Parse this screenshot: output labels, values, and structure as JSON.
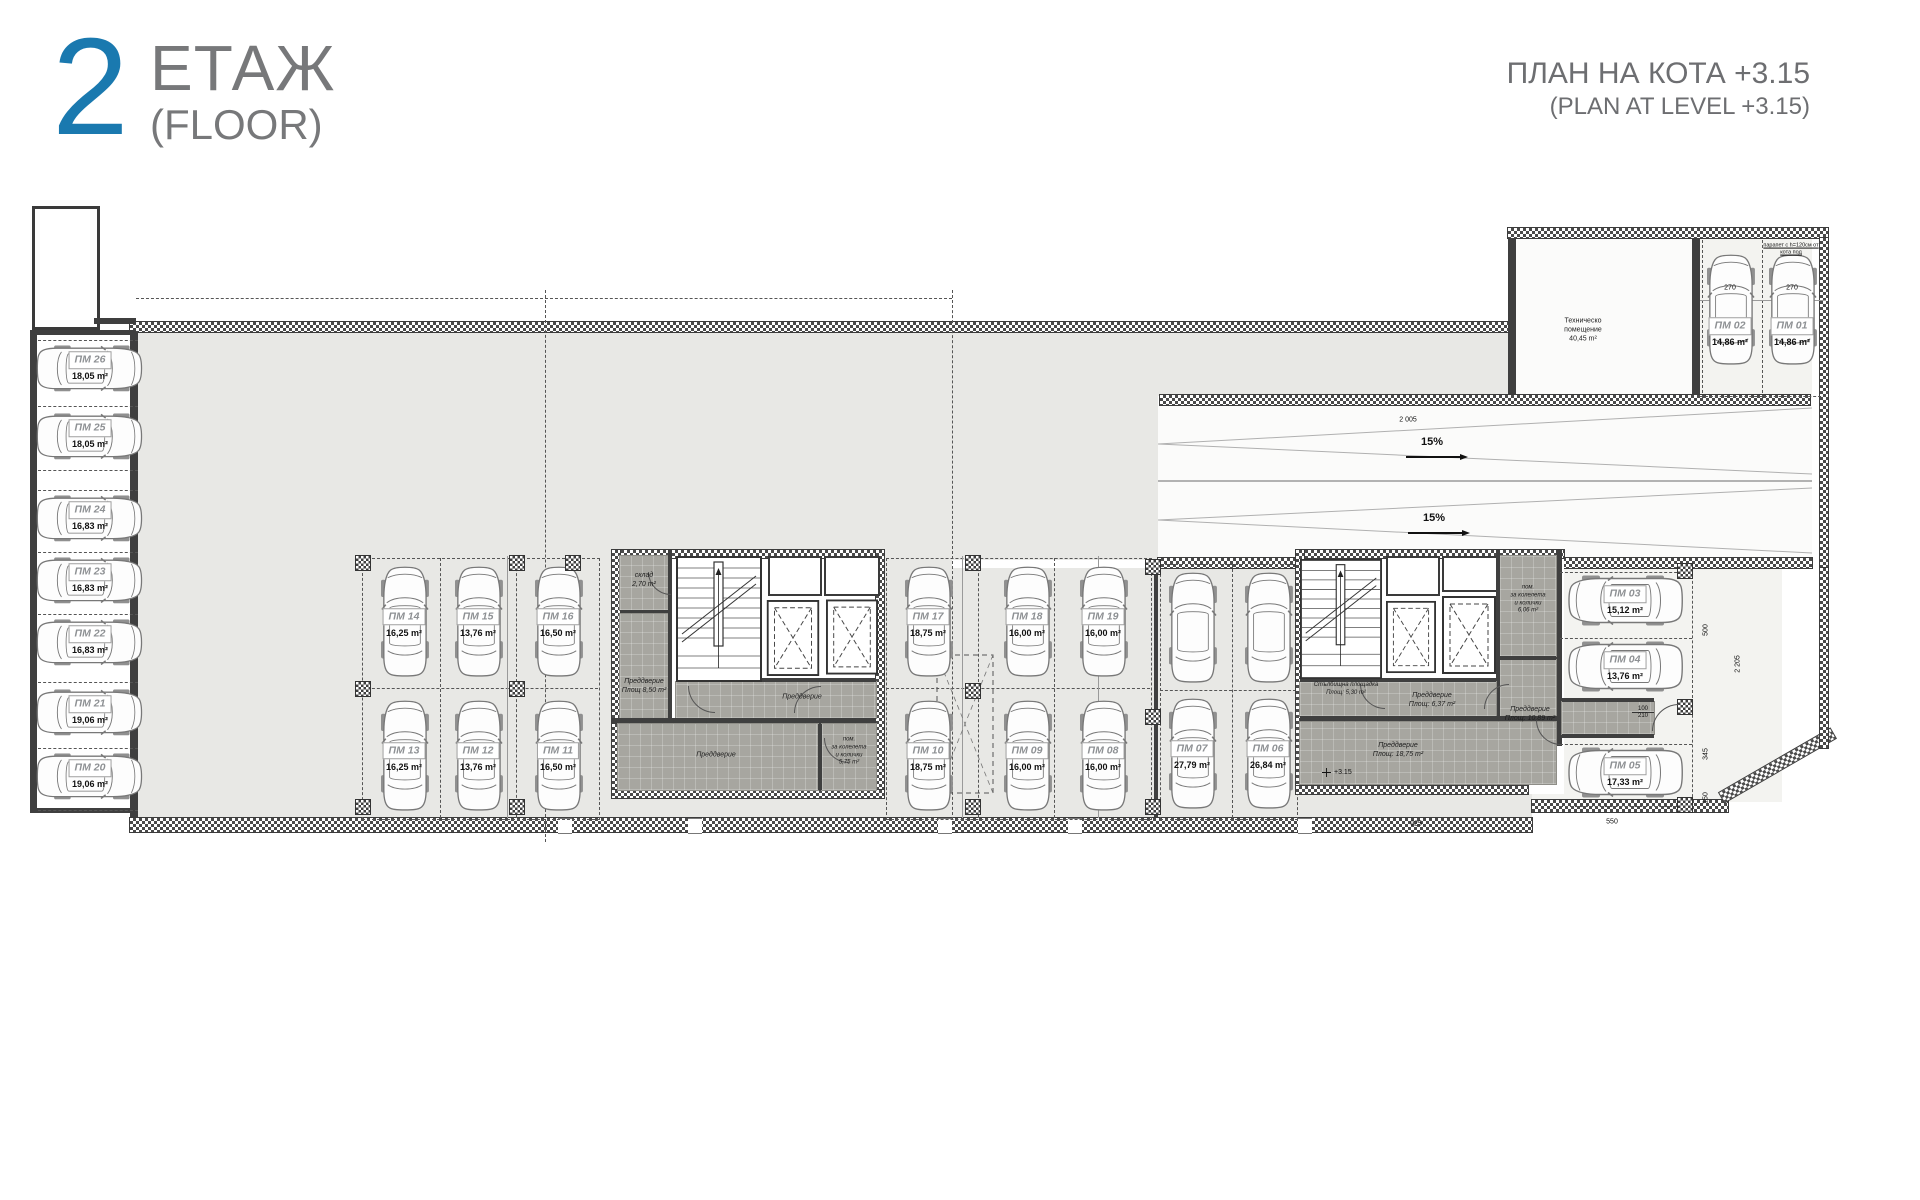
{
  "header": {
    "floor_number": "2",
    "floor_label": "ЕТАЖ",
    "floor_label_en": "(FLOOR)",
    "plan_title": "ПЛАН НА КОТА +3.15",
    "plan_title_en": "(PLAN AT LEVEL +3.15)",
    "accent_color": "#1a79af",
    "text_color": "#6d6e71"
  },
  "plan": {
    "spots": [
      {
        "id": "ПМ 01",
        "area": "14,86 m²"
      },
      {
        "id": "ПМ 02",
        "area": "14,86 m²"
      },
      {
        "id": "ПМ 03",
        "area": "15,12 m²"
      },
      {
        "id": "ПМ 04",
        "area": "13,76 m²"
      },
      {
        "id": "ПМ 05",
        "area": "17,33 m²"
      },
      {
        "id": "ПМ 06",
        "area": "26,84 m²"
      },
      {
        "id": "ПМ 07",
        "area": "27,79 m²"
      },
      {
        "id": "ПМ 08",
        "area": "16,00 m²"
      },
      {
        "id": "ПМ 09",
        "area": "16,00 m²"
      },
      {
        "id": "ПМ 10",
        "area": "18,75 m²"
      },
      {
        "id": "ПМ 11",
        "area": "16,50 m²"
      },
      {
        "id": "ПМ 12",
        "area": "13,76 m²"
      },
      {
        "id": "ПМ 13",
        "area": "16,25 m²"
      },
      {
        "id": "ПМ 14",
        "area": "16,25 m²"
      },
      {
        "id": "ПМ 15",
        "area": "13,76 m²"
      },
      {
        "id": "ПМ 16",
        "area": "16,50 m²"
      },
      {
        "id": "ПМ 17",
        "area": "18,75 m²"
      },
      {
        "id": "ПМ 18",
        "area": "16,00 m²"
      },
      {
        "id": "ПМ 19",
        "area": "16,00 m²"
      },
      {
        "id": "ПМ 20",
        "area": "19,06 m²"
      },
      {
        "id": "ПМ 21",
        "area": "19,06 m²"
      },
      {
        "id": "ПМ 22",
        "area": "16,83 m²"
      },
      {
        "id": "ПМ 23",
        "area": "16,83 m²"
      },
      {
        "id": "ПМ 24",
        "area": "16,83 m²"
      },
      {
        "id": "ПМ 25",
        "area": "18,05 m²"
      },
      {
        "id": "ПМ 26",
        "area": "18,05 m²"
      }
    ],
    "rooms": {
      "tech": "Техническо\nпомещение\n40,45 m²",
      "storage": "склад\n2,70 m²",
      "vestibule_850": "Преддверие\nПлощ 8,50 m²",
      "vestibule_plain_strip": "Преддверие",
      "vestibule_plain_bottom": "Преддверие",
      "bike_room_left": "пом.\nза колелета\nи колички\n5,75 m²",
      "stair_landing": "Стълбищна площадка\nПлощ: 5,30 m²",
      "vestibule_637": "Преддверие\nПлощ: 6,37 m²",
      "bike_room_right": "пом.\nза колелета\nи колички\n6,06 m²",
      "vestibule_1089": "Преддверие\nПлощ: 10,89 m²",
      "vestibule_1875": "Преддверие\nПлощ: 18,75 m²"
    },
    "ramp": {
      "slope_upper": "15%",
      "slope_lower": "15%",
      "dim": "2 005"
    },
    "notes": {
      "parapet": "парапет с h=120см от\nкота под",
      "level": "+3.15"
    },
    "dims": {
      "bay_left": "270",
      "bay_right": "270",
      "core_bottom": "925",
      "wing_bottom": "550",
      "wing_right_1": "500",
      "wing_right_2": "2 205",
      "wing_right_3": "345",
      "wing_right_4": "150",
      "door_top": "100",
      "door_bottom": "210"
    }
  }
}
